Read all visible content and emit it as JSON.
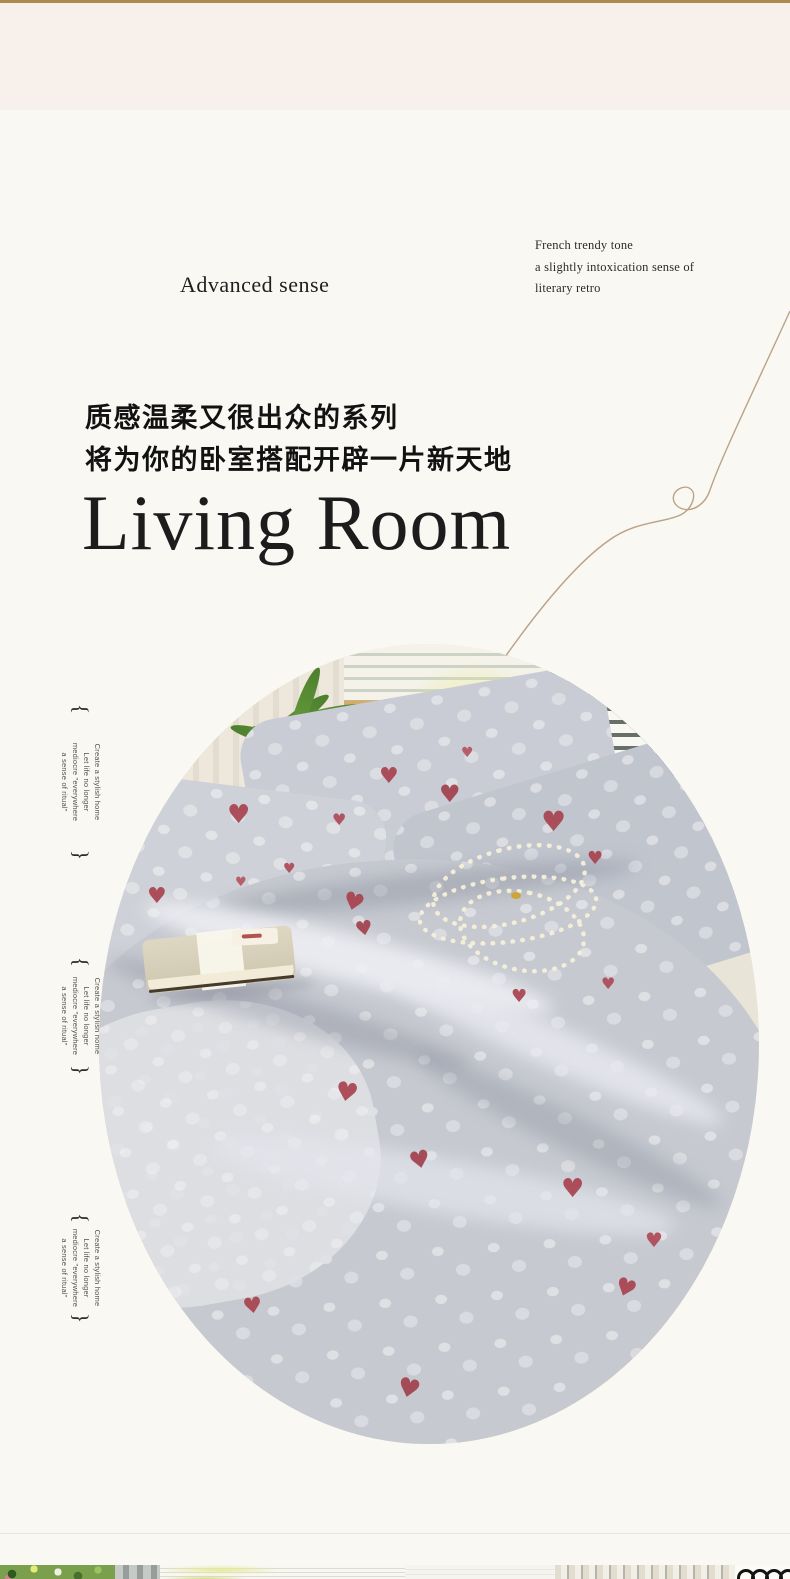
{
  "page": {
    "background_color": "#faf8f3",
    "top_band_color": "#f7f0eb",
    "accent_bar_color": "#ab8b50"
  },
  "header": {
    "brand_word": "Advanced sense",
    "tagline_lines": [
      "French trendy tone",
      "a slightly intoxication sense of",
      "literary retro"
    ]
  },
  "intro": {
    "headline_cn_lines": [
      "质感温柔又很出众的系列",
      "将为你的卧室搭配开辟一片新天地"
    ],
    "title_en": "Living Room"
  },
  "side_note": {
    "bracket_open": "{",
    "bracket_close": "}",
    "lines": [
      "Create a stylish home",
      "Let life no longer",
      "mediocre \"everywhere",
      "a sense of ritual\""
    ]
  },
  "photo": {
    "description_colors": {
      "bedding_gray": "#c6c9d0",
      "heart_red": "#a8434f",
      "rattan_tan": "#d9c296",
      "plant_green": "#5d9338"
    },
    "heart_glyph": "♥"
  }
}
